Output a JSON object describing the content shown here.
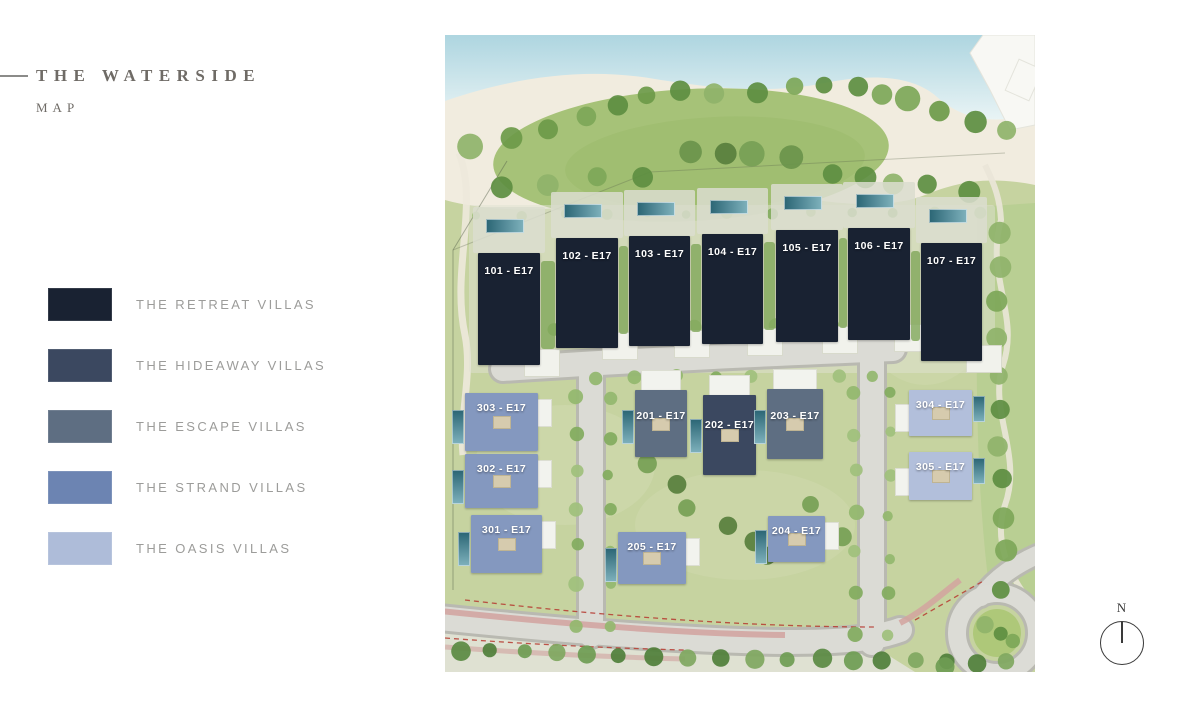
{
  "header": {
    "title": "THE WATERSIDE",
    "subtitle": "MAP"
  },
  "legend": {
    "items": [
      {
        "label": "THE RETREAT VILLAS",
        "group": "retreat",
        "color": "#192232"
      },
      {
        "label": "THE HIDEAWAY VILLAS",
        "group": "hideaway",
        "color": "#3b4860"
      },
      {
        "label": "THE ESCAPE VILLAS",
        "group": "escape",
        "color": "#5e6e82"
      },
      {
        "label": "THE STRAND VILLAS",
        "group": "strand",
        "color": "#6c84b2"
      },
      {
        "label": "THE OASIS VILLAS",
        "group": "oasis",
        "color": "#aebcd9"
      }
    ]
  },
  "map": {
    "villas": [
      {
        "id": "101",
        "label": "101 - E17",
        "group": "retreat",
        "x": 33,
        "y": 218,
        "w": 62,
        "h": 112
      },
      {
        "id": "102",
        "label": "102 - E17",
        "group": "retreat",
        "x": 111,
        "y": 203,
        "w": 62,
        "h": 110
      },
      {
        "id": "103",
        "label": "103 - E17",
        "group": "retreat",
        "x": 184,
        "y": 201,
        "w": 61,
        "h": 110
      },
      {
        "id": "104",
        "label": "104 - E17",
        "group": "retreat",
        "x": 257,
        "y": 199,
        "w": 61,
        "h": 110
      },
      {
        "id": "105",
        "label": "105 - E17",
        "group": "retreat",
        "x": 331,
        "y": 195,
        "w": 62,
        "h": 112
      },
      {
        "id": "106",
        "label": "106 - E17",
        "group": "retreat",
        "x": 403,
        "y": 193,
        "w": 62,
        "h": 112
      },
      {
        "id": "107",
        "label": "107 - E17",
        "group": "retreat",
        "x": 476,
        "y": 208,
        "w": 61,
        "h": 118
      },
      {
        "id": "201",
        "label": "201 - E17",
        "group": "escape",
        "x": 190,
        "y": 355,
        "w": 52,
        "h": 67
      },
      {
        "id": "202",
        "label": "202 - E17",
        "group": "hideaway",
        "x": 258,
        "y": 360,
        "w": 53,
        "h": 80
      },
      {
        "id": "203",
        "label": "203 - E17",
        "group": "escape",
        "x": 322,
        "y": 354,
        "w": 56,
        "h": 70
      },
      {
        "id": "204",
        "label": "204 - E17",
        "group": "strand",
        "x": 323,
        "y": 481,
        "w": 57,
        "h": 46
      },
      {
        "id": "205",
        "label": "205 - E17",
        "group": "strand",
        "x": 173,
        "y": 497,
        "w": 68,
        "h": 52
      },
      {
        "id": "301",
        "label": "301 - E17",
        "group": "strand",
        "x": 26,
        "y": 480,
        "w": 71,
        "h": 58
      },
      {
        "id": "302",
        "label": "302 - E17",
        "group": "strand",
        "x": 20,
        "y": 419,
        "w": 73,
        "h": 54
      },
      {
        "id": "303",
        "label": "303 - E17",
        "group": "strand",
        "x": 20,
        "y": 358,
        "w": 73,
        "h": 58
      },
      {
        "id": "304",
        "label": "304 - E17",
        "group": "oasis",
        "x": 464,
        "y": 355,
        "w": 63,
        "h": 46
      },
      {
        "id": "305",
        "label": "305 - E17",
        "group": "oasis",
        "x": 464,
        "y": 417,
        "w": 63,
        "h": 48
      }
    ]
  },
  "compass": {
    "north_label": "N"
  }
}
